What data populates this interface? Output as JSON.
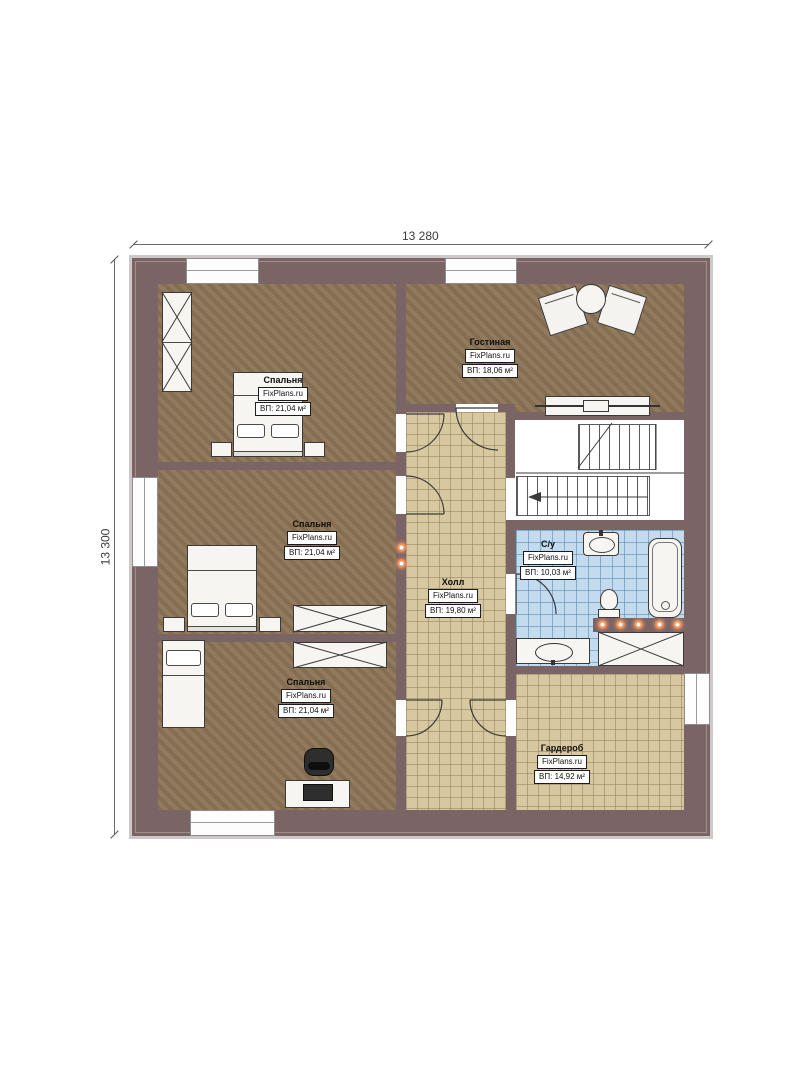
{
  "plan": {
    "source_brand": "FixPlans.ru",
    "dimensions": {
      "top": "13 280",
      "left": "13 300"
    },
    "rooms": [
      {
        "id": "bedroom-1",
        "name": "Спальня",
        "brand": "FixPlans.ru",
        "area": "ВП: 21,04 м²"
      },
      {
        "id": "living-room",
        "name": "Гостиная",
        "brand": "FixPlans.ru",
        "area": "ВП: 18,06 м²"
      },
      {
        "id": "bedroom-2",
        "name": "Спальня",
        "brand": "FixPlans.ru",
        "area": "ВП: 21,04 м²"
      },
      {
        "id": "hall",
        "name": "Холл",
        "brand": "FixPlans.ru",
        "area": "ВП: 19,80 м²"
      },
      {
        "id": "bathroom",
        "name": "С/у",
        "brand": "FixPlans.ru",
        "area": "ВП: 10,03 м²"
      },
      {
        "id": "bedroom-3",
        "name": "Спальня",
        "brand": "FixPlans.ru",
        "area": "ВП: 21,04 м²"
      },
      {
        "id": "wardrobe",
        "name": "Гардероб",
        "brand": "FixPlans.ru",
        "area": "ВП: 14,92 м²"
      }
    ],
    "colors": {
      "wall": "#7b6465",
      "carpet_floor": "#8b7355",
      "tile_floor": "#d8c8a0",
      "bathroom_tile": "#c2dbef",
      "spotlight": "#f0955f"
    }
  }
}
